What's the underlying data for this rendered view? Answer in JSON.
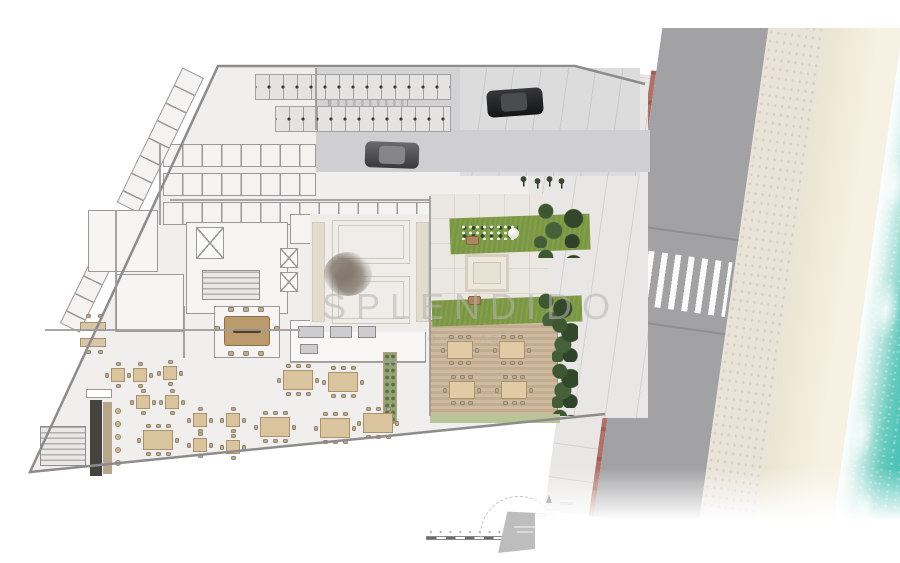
{
  "watermark": {
    "title": "SPLENDIDO",
    "subtitle": "O VELAS"
  },
  "scene": {
    "type": "architectural ground-floor site plan, beachfront building",
    "zones": [
      "motorcycle-parking",
      "parking-drive",
      "storage-lockers",
      "elevator-core",
      "stairs",
      "lobby-lounge",
      "conference-room",
      "offices",
      "kitchen",
      "restaurant-dining",
      "bar",
      "pool-terrace",
      "garden-lawn",
      "outdoor-dining-deck",
      "plaza-sidewalk",
      "road",
      "crosswalk",
      "promenade",
      "beach-sand",
      "ocean"
    ],
    "cars_visible": 2,
    "crosswalk_stripes": 10,
    "indoor_tables_4_seat": 9,
    "indoor_tables_8_seat": 6,
    "deck_tables": 4
  },
  "key_plan": {
    "scale_bar_segments": 8,
    "north_arrow": true,
    "footprint_highlighted": true
  },
  "colors": {
    "background": "#ffffff",
    "plan_fill": "#f0efed",
    "wall": "#9b9b9b",
    "asphalt": "#d2d2d4",
    "road": "#a2a2a4",
    "curb_red": "#b0716a",
    "promenade": "#e9e3d8",
    "sand": "#f3ecdc",
    "ocean": "#3bbbb0",
    "foam": "#ffffff",
    "lawn": "#7a9742",
    "shrub": "#33482a",
    "deck_wood": "#c7b298",
    "table_wood": "#dac49e",
    "conference_table": "#bb9b6e",
    "bar_dark": "#45433f",
    "watermark": "#b6b4b0"
  },
  "icons": [
    "north-arrow-icon",
    "scale-bar",
    "car",
    "elevator-x-glyph",
    "stairs-hatch",
    "tree-scribble",
    "shrub-cluster",
    "street-tree-icon",
    "crosswalk-stripes"
  ]
}
